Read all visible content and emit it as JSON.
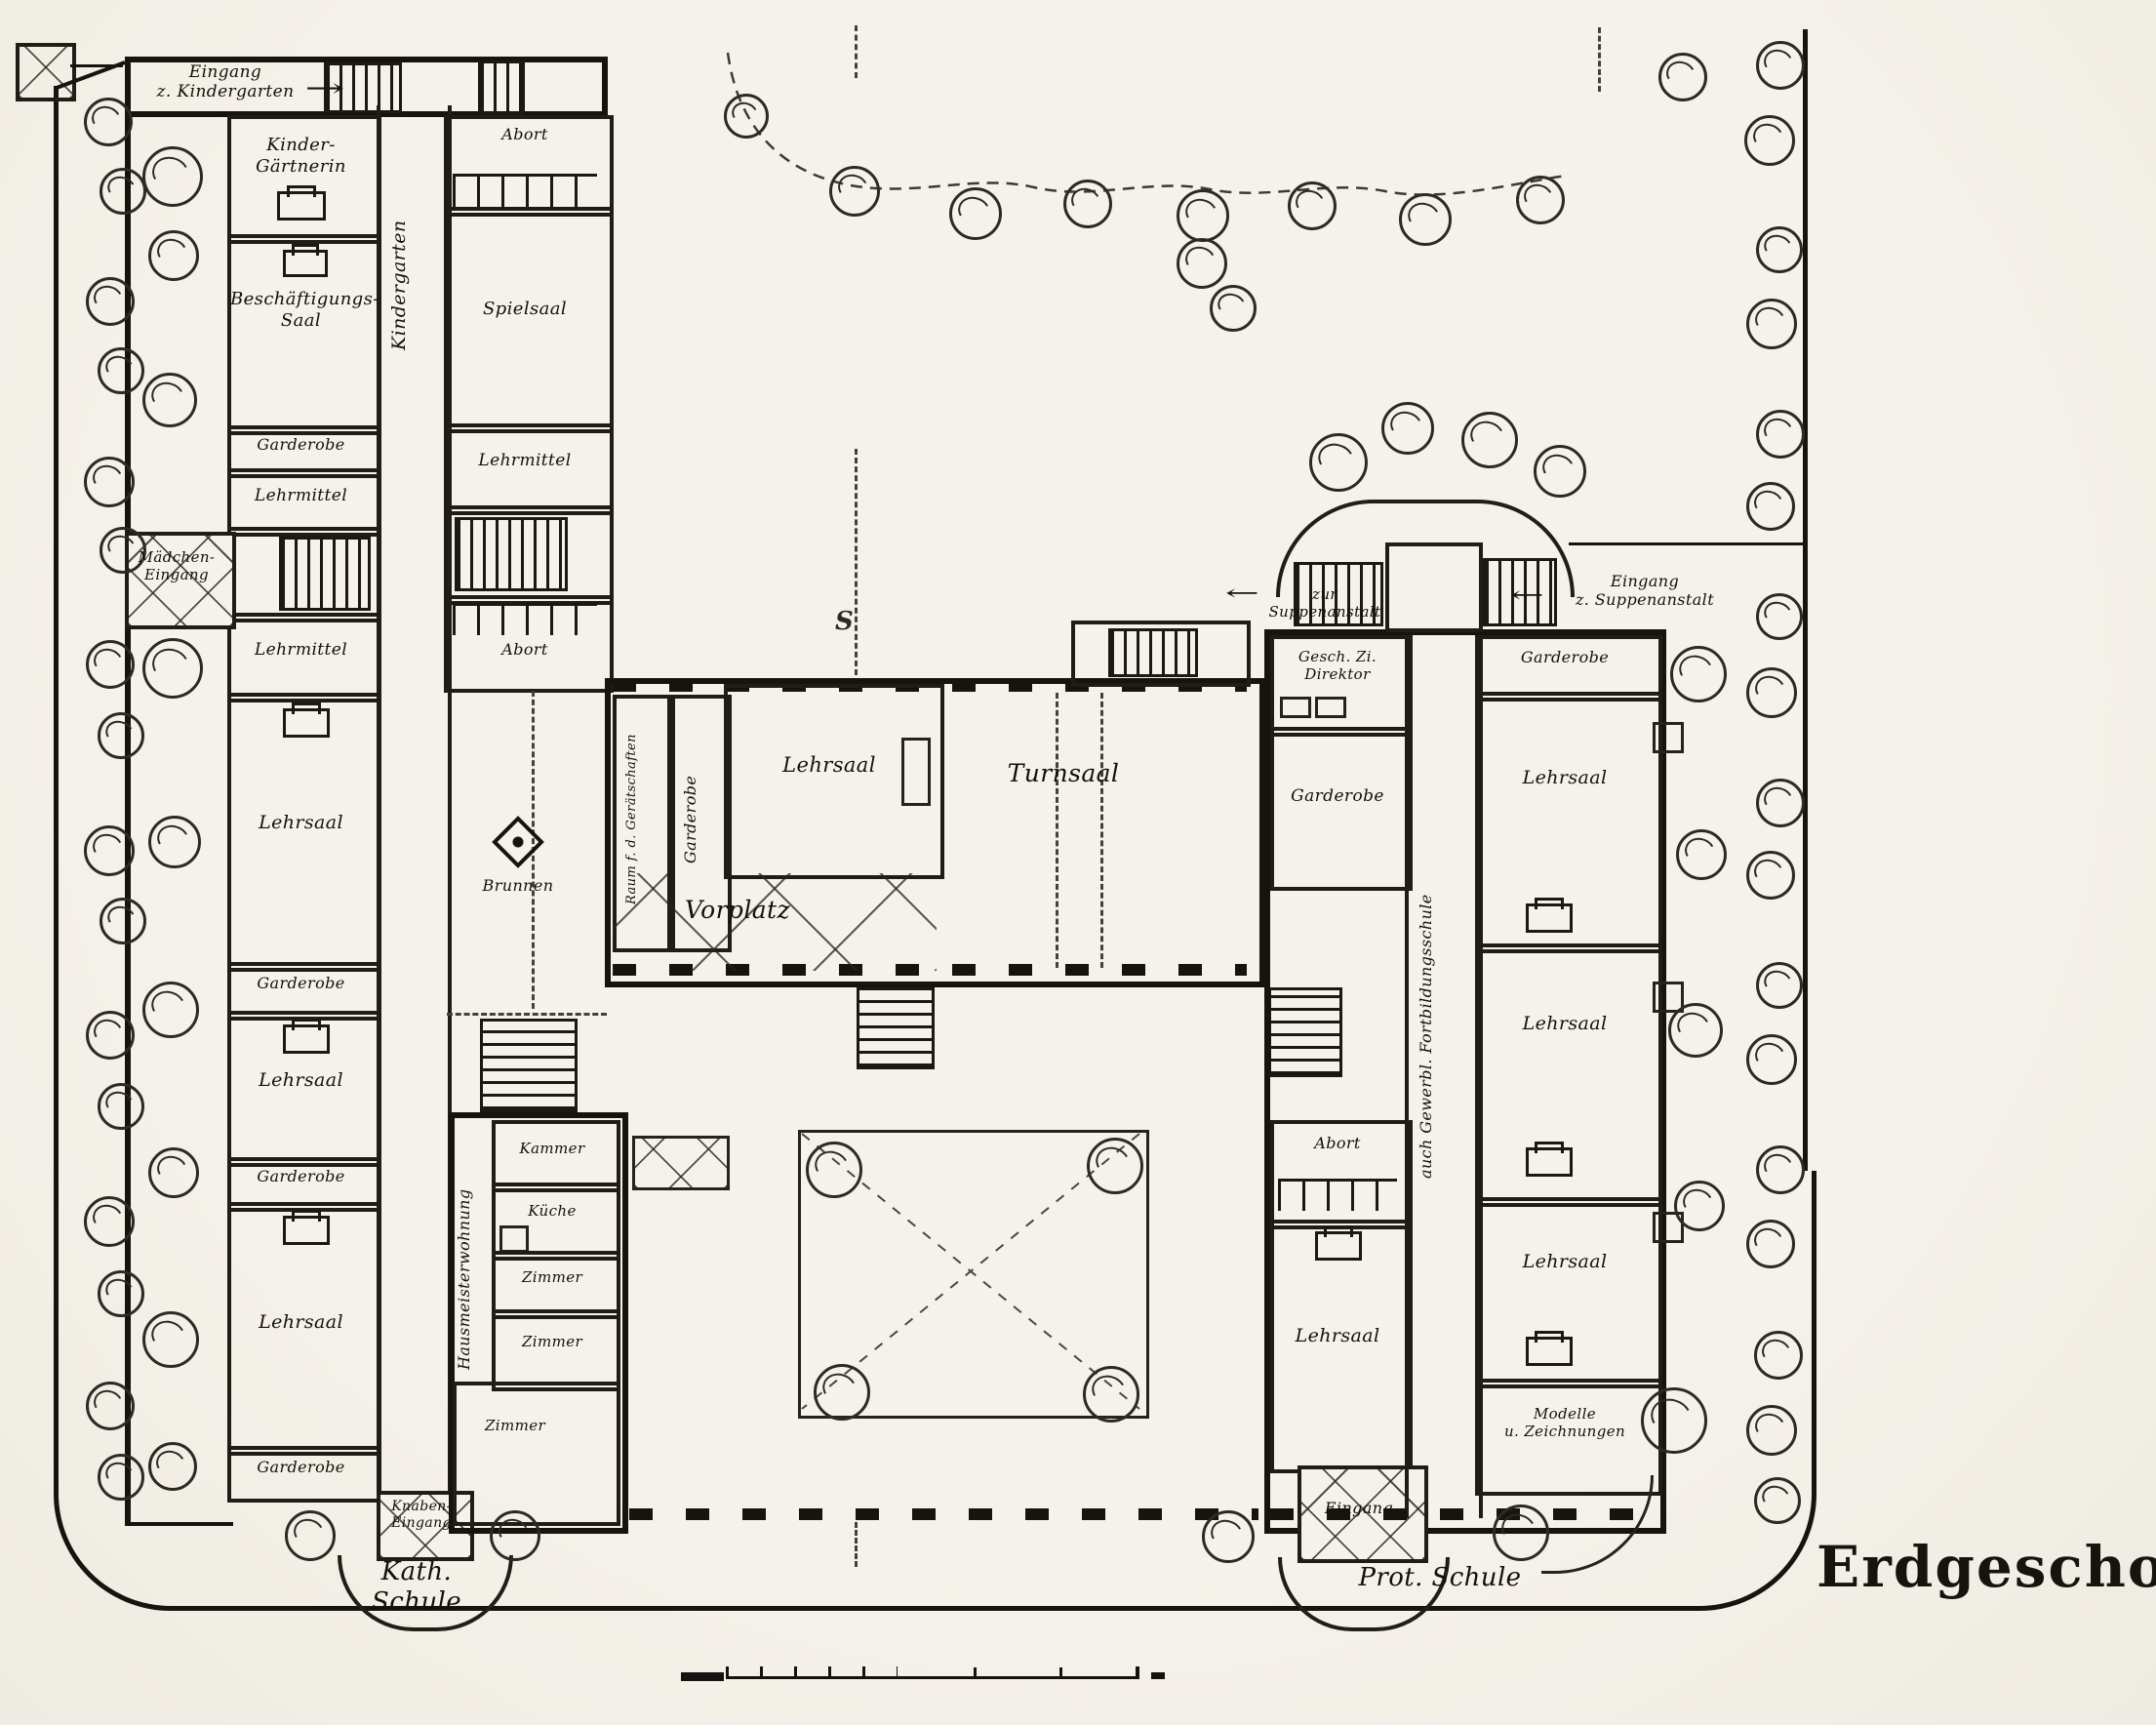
{
  "title": "Erdgeschoß",
  "labels": {
    "eingang_kindergarten": "Eingang\nz. Kindergarten",
    "kindergarten": "Kindergarten",
    "kinder_gaertnerin": "Kinder-\nGärtnerin",
    "beschaeftigungs_saal": "Beschäftigungs-\nSaal",
    "garderobe": "Garderobe",
    "lehrmittel": "Lehrmittel",
    "maedchen_eingang": "Mädchen-\nEingang",
    "lehrsaal": "Lehrsaal",
    "abort": "Abort",
    "spielsaal": "Spielsaal",
    "brunnen": "Brunnen",
    "raum_geraetschaften": "Raum f. d. Gerätschaften",
    "vorplatz": "Vorplatz",
    "turnsaal": "Turnsaal",
    "zur_suppenanstalt": "zur Suppenanstalt",
    "eingang_suppenanstalt": "Eingang\nz. Suppenanstalt",
    "gesch_zi_direktor": "Gesch. Zi.\nDirektor",
    "fortbildungsschule": "auch Gewerbl. Fortbildungsschule",
    "modelle_zeichnungen": "Modelle\nu. Zeichnungen",
    "hausmeisterwohnung": "Hausmeisterwohnung",
    "kammer": "Kammer",
    "kueche": "Küche",
    "zimmer": "Zimmer",
    "eingang": "Eingang",
    "knaben_eingang": "Knaben-\nEingang",
    "kath_schule": "Kath. Schule",
    "prot_schule": "Prot. Schule"
  },
  "icons": {
    "arrow_right": "→",
    "arrow_left": "←",
    "section_mark": "S"
  }
}
